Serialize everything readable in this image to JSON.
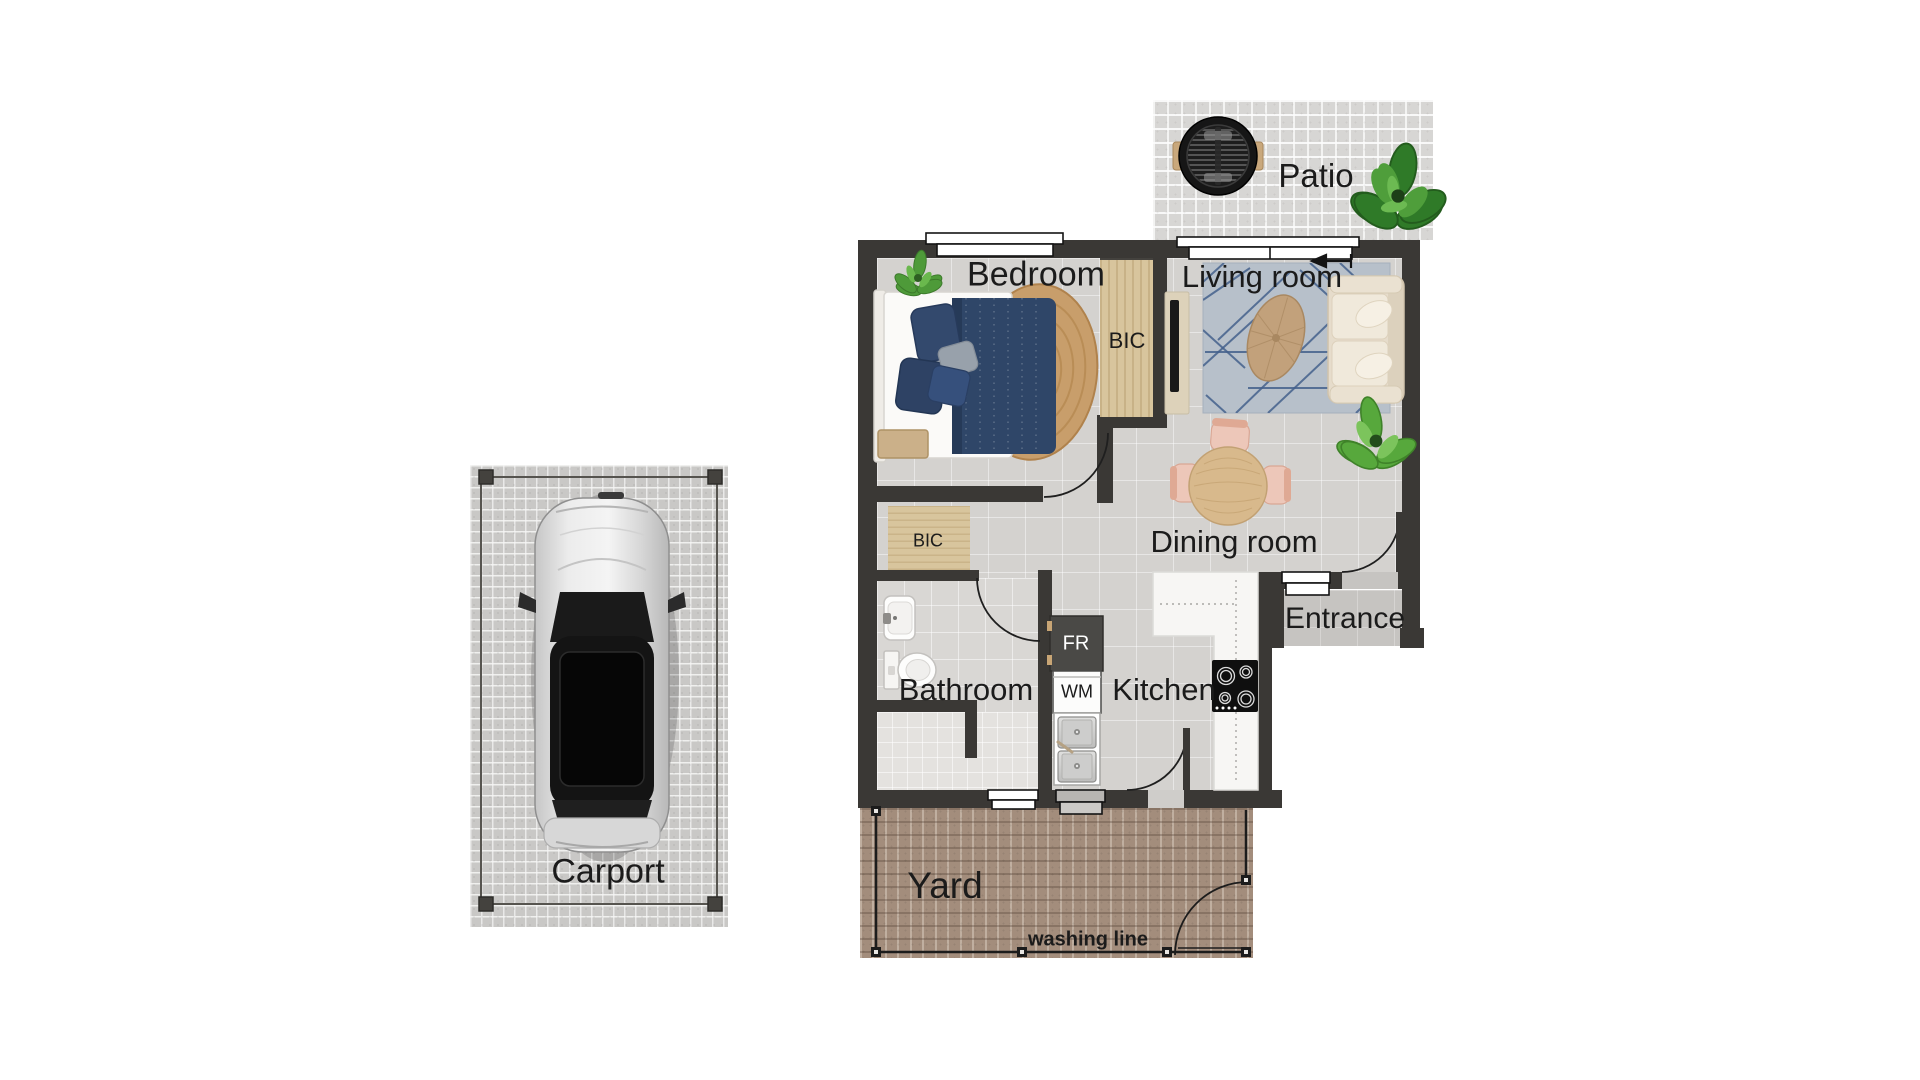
{
  "page": {
    "background": "#ffffff",
    "type": "residential floor plan"
  },
  "rooms": {
    "patio": {
      "label": "Patio"
    },
    "bedroom": {
      "label": "Bedroom"
    },
    "living_room": {
      "label": "Living room"
    },
    "dining_room": {
      "label": "Dining room"
    },
    "kitchen": {
      "label": "Kitchen"
    },
    "bathroom": {
      "label": "Bathroom"
    },
    "entrance": {
      "label": "Entrance"
    },
    "yard": {
      "label": "Yard"
    },
    "carport": {
      "label": "Carport"
    }
  },
  "fixtures": {
    "bedroom_cupboard": {
      "label": "BIC"
    },
    "hallway_cupboard": {
      "label": "BIC"
    },
    "fridge": {
      "label": "FR"
    },
    "washing_machine": {
      "label": "WM"
    },
    "washing_line": {
      "label": "washing line"
    }
  },
  "colors": {
    "wall": "#3a3835",
    "interior_floor": "#d4d2cf",
    "patio_paving": "#d7d6d4",
    "carport_paving": "#c9c8c6",
    "yard_paving": "#a38d7c",
    "cupboard_wood": "#d8c59d",
    "bed_navy": "#2f4668",
    "sofa_cream": "#e6dccb",
    "living_rug_blue": "#b7c0ca",
    "chair_blush": "#edc7b9",
    "plant_green": "#57a83c",
    "label_text": "#1b1b1b"
  }
}
